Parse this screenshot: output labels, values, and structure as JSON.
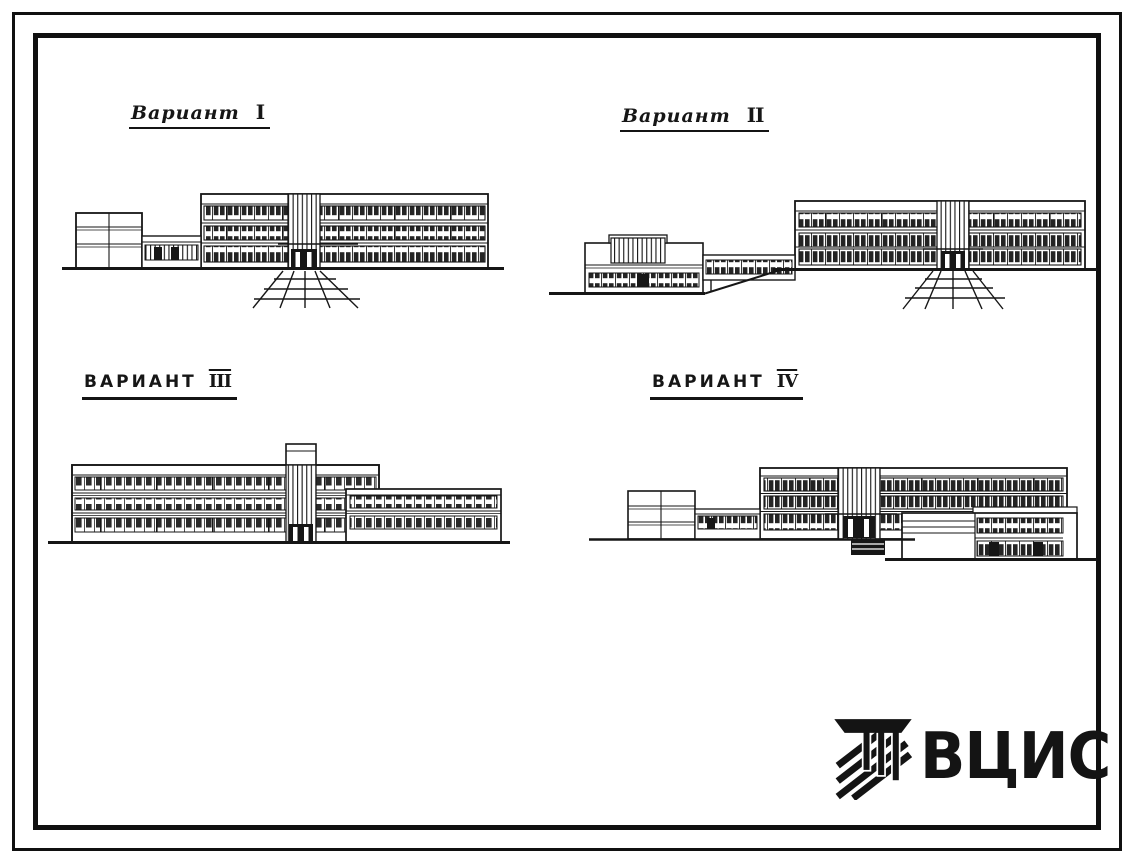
{
  "colors": {
    "paper": "#ffffff",
    "ink": "#161616"
  },
  "variants": [
    {
      "word": "Вариант",
      "numeral": "I"
    },
    {
      "word": "Вариант",
      "numeral": "II"
    },
    {
      "word": "ВАРИАНТ",
      "numeral": "III"
    },
    {
      "word": "ВАРИАНТ",
      "numeral": "IV"
    }
  ],
  "logo": {
    "text": "ВЦИС"
  }
}
